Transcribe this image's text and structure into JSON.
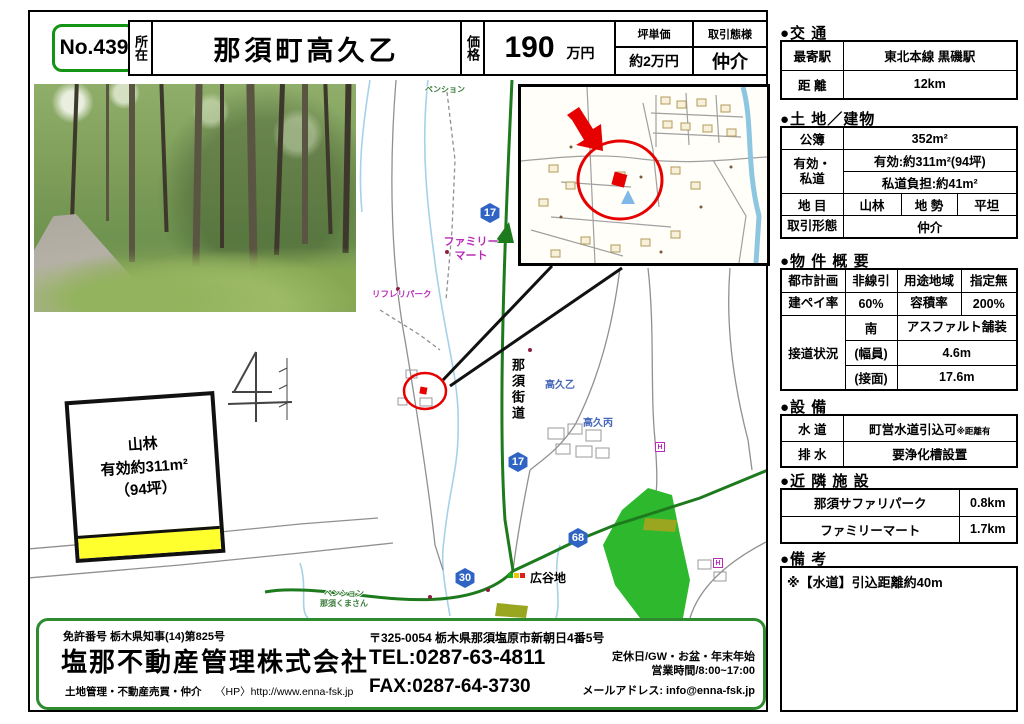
{
  "header": {
    "no": "No.439",
    "shozai_label": "所在",
    "shozai": "那須町高久乙",
    "kakaku_label": "価格",
    "kakaku_value": "190",
    "kakaku_unit": "万円",
    "tsubo_label": "坪単価",
    "tsubo_value": "約2万円",
    "torihiki_label": "取引態様",
    "torihiki_value": "仲介"
  },
  "sidebar": {
    "koutsu": {
      "title": "●交 通",
      "moyori_label": "最寄駅",
      "moyori": "東北本線 黒磯駅",
      "kyori_label": "距 離",
      "kyori": "12km"
    },
    "tochi": {
      "title": "●土 地／建物",
      "kobo_label": "公簿",
      "kobo": "352m²",
      "yuko_label1": "有効・",
      "yuko_label2": "私道",
      "yuko": "有効:約311m²(94坪)",
      "shido": "私道負担:約41m²",
      "chimoku_label": "地 目",
      "chimoku": "山林",
      "chisei_label": "地 勢",
      "chisei": "平坦",
      "keitai_label": "取引形態",
      "keitai": "仲介"
    },
    "gaiyo": {
      "title": "●物 件 概 要",
      "toshi_label": "都市計画",
      "toshi": "非線引",
      "yoto_label": "用途地域",
      "yoto": "指定無",
      "kenpei_label": "建ペイ率",
      "kenpei": "60%",
      "yoseki_label": "容積率",
      "yoseki": "200%",
      "setsudo_label": "接道状況",
      "muki": "南",
      "hoso": "アスファルト舗装",
      "fukuin_label": "(幅員)",
      "fukuin": "4.6m",
      "setsumen_label": "(接面)",
      "setsumen": "17.6m"
    },
    "setsubi": {
      "title": "●設 備",
      "suido_label": "水 道",
      "suido": "町営水道引込可",
      "suido_note": "※距離有",
      "haisui_label": "排 水",
      "haisui": "要浄化槽設置"
    },
    "kinrin": {
      "title": "●近 隣 施 設",
      "items": [
        {
          "name": "那須サファリパーク",
          "dist": "0.8km"
        },
        {
          "name": "ファミリーマート",
          "dist": "1.7km"
        }
      ]
    },
    "biko": {
      "title": "●備 考",
      "text": "※【水道】引込距離約40m"
    }
  },
  "plot": {
    "line1": "山林",
    "line2": "有効約311m²",
    "line3": "（94坪）"
  },
  "map": {
    "nasukaido": "那須街道",
    "famima1": "ファミリー",
    "famima2": "マート",
    "hiroyachi": "広谷地",
    "takaku_otsu": "高久乙",
    "takaku_hei": "高久丙",
    "pension_top": "ペンション",
    "pension_bottom1": "ペンション",
    "pension_bottom2": "那須くまさん",
    "refre": "リフレリパーク",
    "r17": "17",
    "r30": "30",
    "r68": "68",
    "h_icon": "H"
  },
  "footer": {
    "license": "免許番号 栃木県知事(14)第825号",
    "company": "塩那不動産管理株式会社",
    "services": "土地管理・不動産売買・仲介",
    "hp": "〈HP〉http://www.enna-fsk.jp",
    "address": "〒325-0054 栃木県那須塩原市新朝日4番5号",
    "tel": "TEL:0287-63-4811",
    "fax": "FAX:0287-64-3730",
    "holiday": "定休日/GW・お盆・年末年始",
    "hours": "営業時間/8:00~17:00",
    "email": "メールアドレス: info@enna-fsk.jp"
  }
}
